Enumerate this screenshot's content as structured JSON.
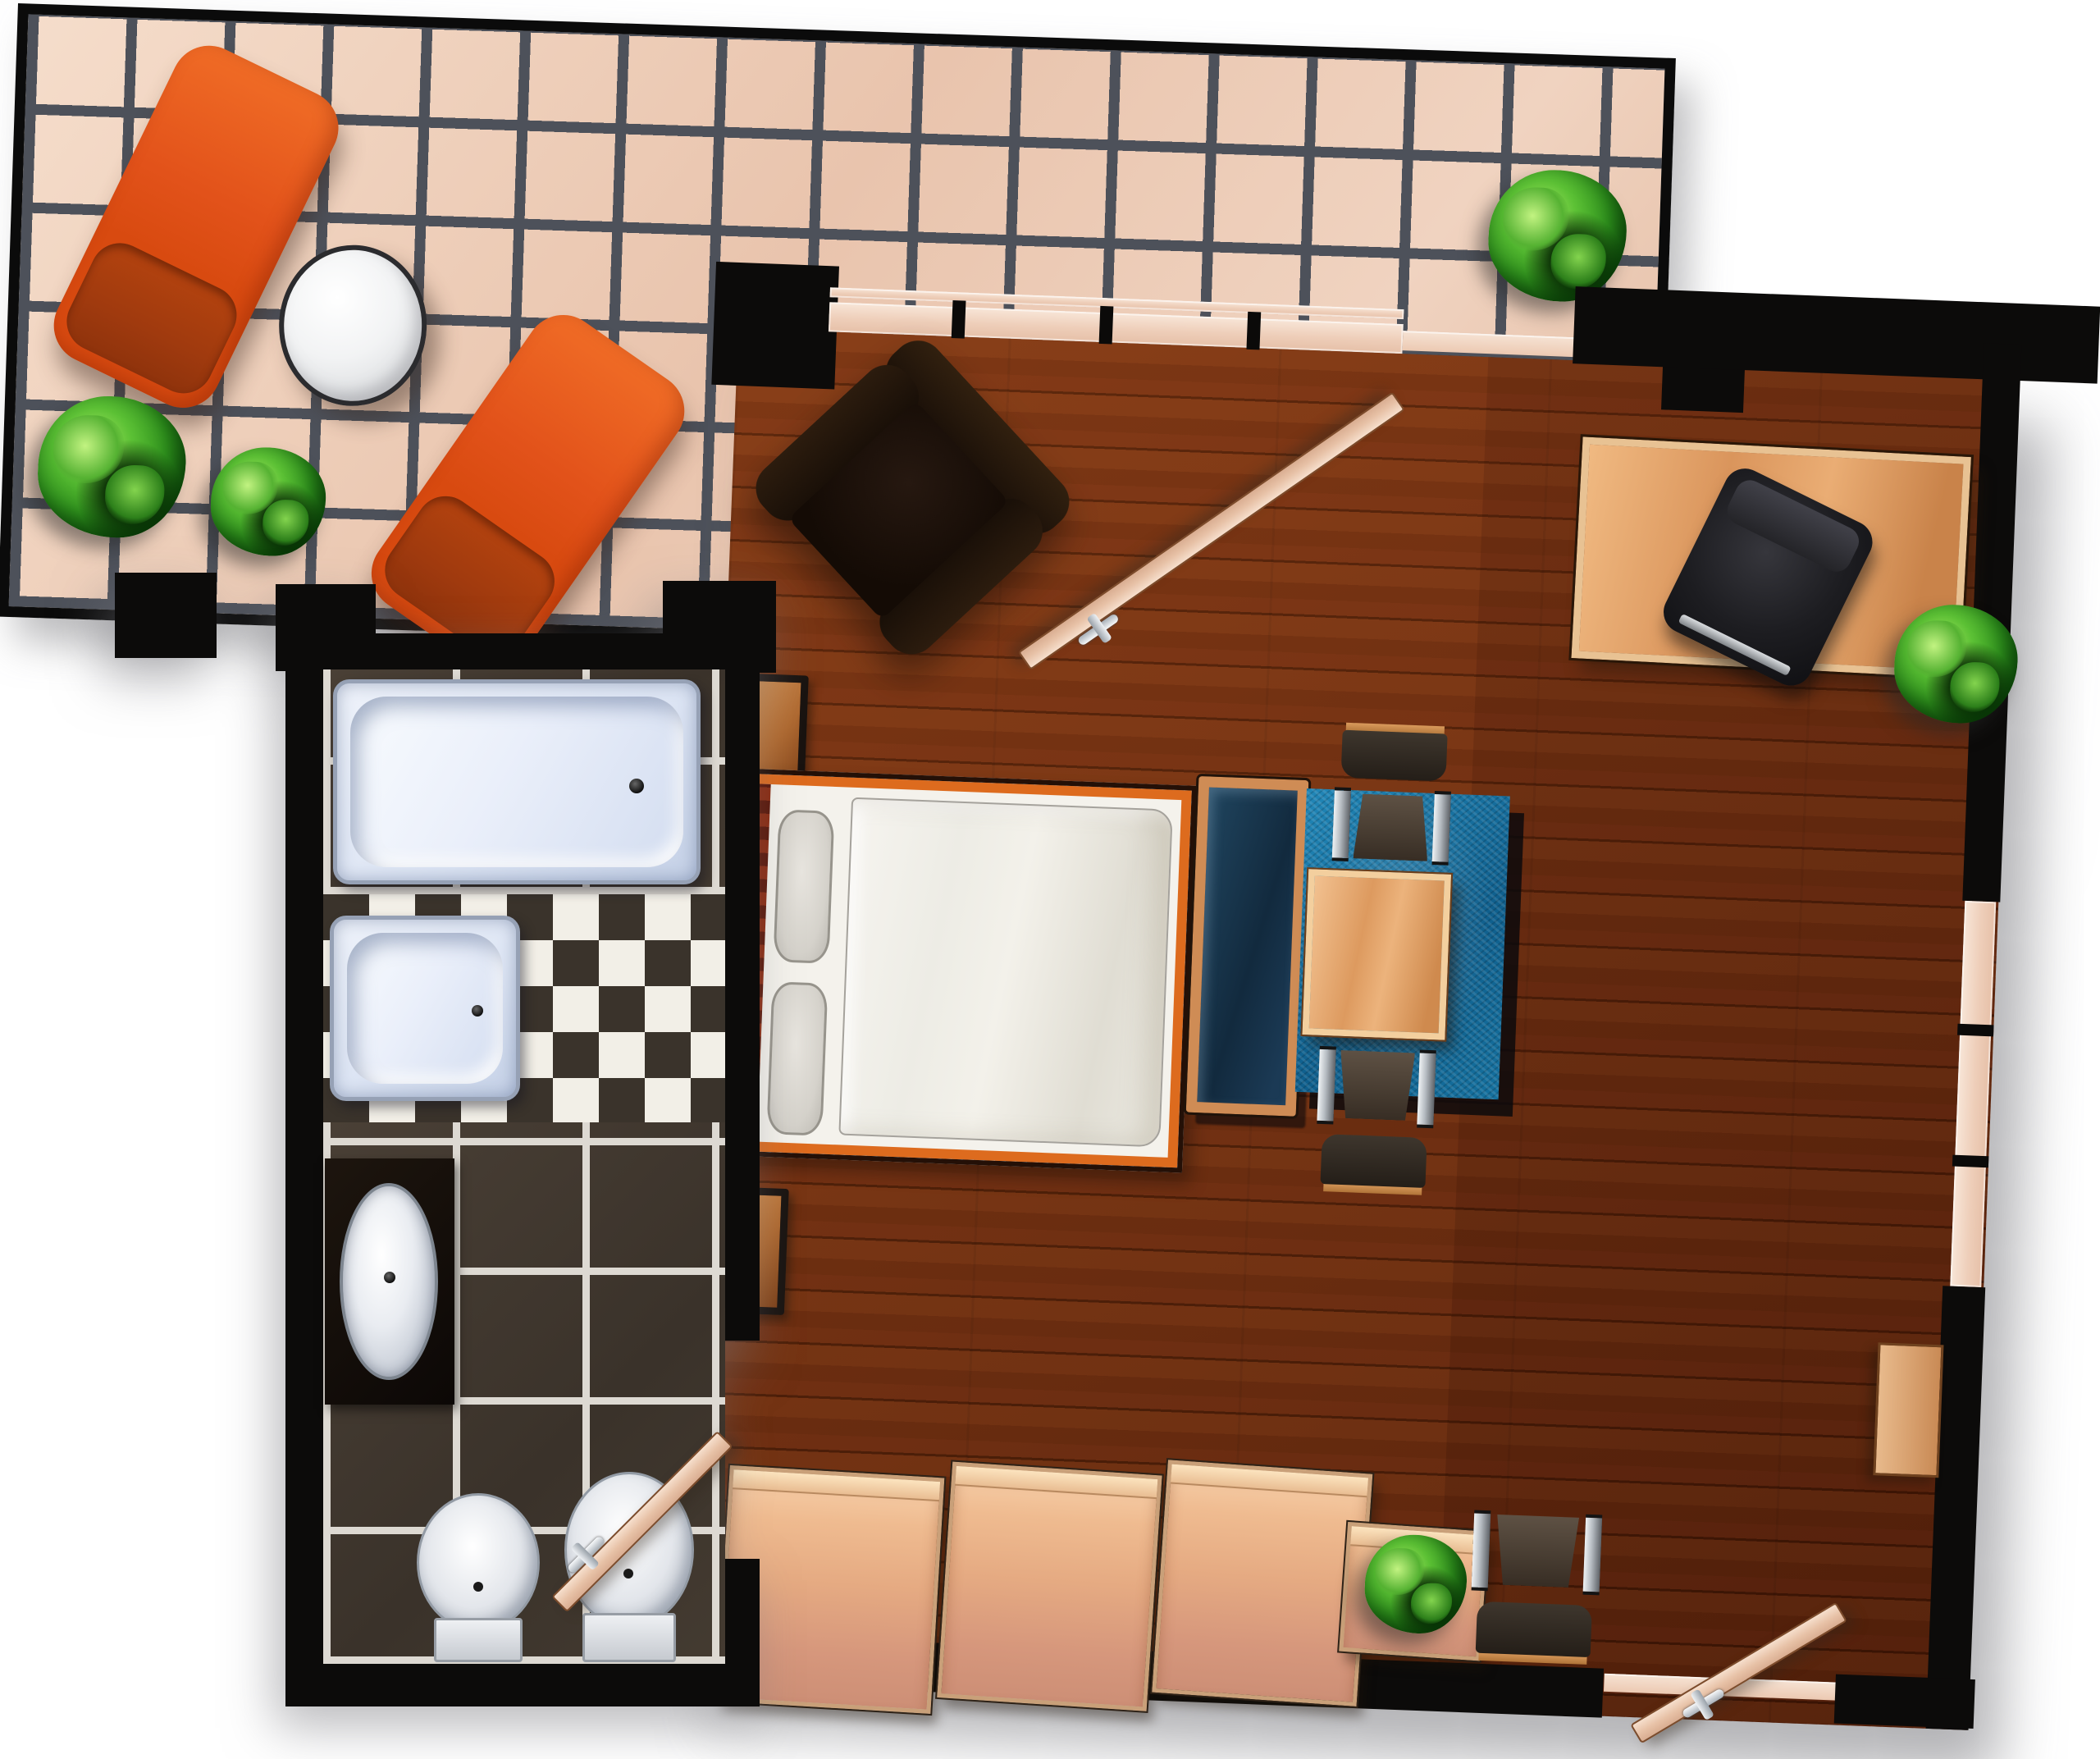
{
  "page": {
    "title": "Studio apartment floor plan – top-down view",
    "visible_text": "none",
    "background": "#ffffff"
  },
  "palette": {
    "wall": "#0c0b0a",
    "wood_floor": "#702d0f",
    "terrace_tile": "#eccab3",
    "terrace_grout": "#4d515a",
    "bath_dark_tile": "#3f372e",
    "checker_light": "#f2efe7",
    "checker_dark": "#3a332b",
    "lounger_orange": "#e2521a",
    "rug_blue": "#15719f",
    "bed_frame_orange": "#dd6b1e",
    "furniture_wood": "#dd9a5f",
    "plant_green": "#2f921d",
    "sanitary_white": "#eaeffa"
  },
  "rooms": {
    "terrace": {
      "label": "Tiled terrace",
      "floor": "beige ceramic tiles with dark grout",
      "items": {
        "lounger_left": {
          "label": "orange sun lounger (upper)"
        },
        "lounger_right": {
          "label": "orange sun lounger (lower)"
        },
        "side_table": {
          "label": "round white bistro table"
        },
        "shrub_large": {
          "label": "large green shrub"
        },
        "shrub_small": {
          "label": "small green shrub"
        },
        "shrub_corner": {
          "label": "shrub near terrace door"
        }
      }
    },
    "bathroom": {
      "label": "Bathroom",
      "floor": "dark brown tiles and black & white checkerboard",
      "items": {
        "bathtub": {
          "label": "bathtub"
        },
        "shower_tray": {
          "label": "shower tray"
        },
        "washbasin": {
          "label": "oval washbasin on dark counter"
        },
        "toilet": {
          "label": "toilet"
        },
        "bidet": {
          "label": "bidet"
        },
        "door": {
          "label": "bathroom door, open"
        }
      }
    },
    "living_room": {
      "label": "Living / sleeping room",
      "floor": "dark cherry wood planks",
      "items": {
        "armchair": {
          "label": "dark leather armchair"
        },
        "double_bed": {
          "label": "double bed with two pillows and duvet"
        },
        "nightstand_top": {
          "label": "nightstand above bed"
        },
        "nightstand_bottom": {
          "label": "nightstand below bed"
        },
        "bench": {
          "label": "upholstered bench at foot of bed"
        },
        "rug": {
          "label": "blue dining rug"
        },
        "dining_table": {
          "label": "square wooden dining table"
        },
        "chair_north": {
          "label": "dining chair (upper)"
        },
        "chair_south": {
          "label": "dining chair (lower)"
        },
        "desk": {
          "label": "wooden desk"
        },
        "office_chair": {
          "label": "black office chair"
        },
        "wardrobe_1": {
          "label": "wardrobe element 1"
        },
        "wardrobe_2": {
          "label": "wardrobe element 2"
        },
        "wardrobe_3": {
          "label": "wardrobe element 3"
        },
        "plant_cabinet": {
          "label": "low cabinet with plant"
        },
        "side_chair": {
          "label": "side chair at south wall"
        },
        "wall_shelf": {
          "label": "small shelf on east wall"
        },
        "plant_east": {
          "label": "shrub at east wall"
        },
        "terrace_door": {
          "label": "terrace door, open inward"
        },
        "entry_door": {
          "label": "entrance door, open inward"
        }
      }
    }
  }
}
